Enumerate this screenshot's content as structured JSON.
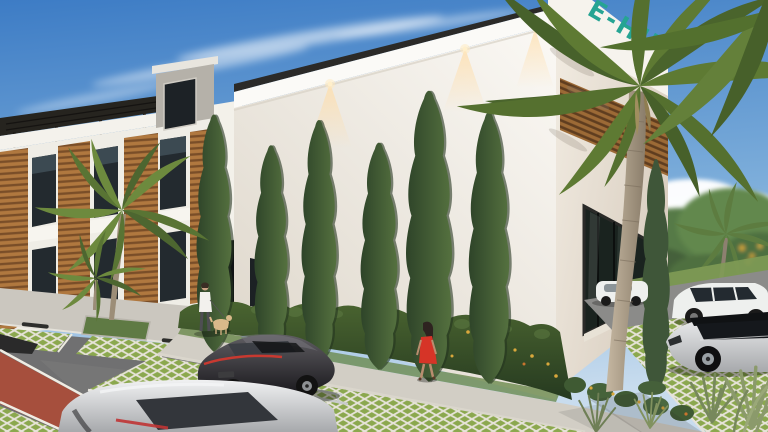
{
  "signage": {
    "text": "E-HUB"
  },
  "palette": {
    "sky_top": "#3d7cc5",
    "sky_mid": "#7cadda",
    "sky_horizon": "#c8dcee",
    "wall_light": "#fbf9f5",
    "wall_shade": "#ded7cb",
    "right_face_light": "#f2ece2",
    "right_face_shade": "#d8cdbf",
    "roof_dark": "#2b2a28",
    "wood": "#b0783f",
    "wood_dark": "#7a4e28",
    "cypress_light": "#55713f",
    "cypress_dark": "#2e4429",
    "hedge_light": "#4a6430",
    "hedge_dark": "#263a20",
    "palm_green": "#5e7a33",
    "palm_green_dark": "#47602a",
    "asphalt": "#707071",
    "red_lane": "#a64f3d",
    "paver_green": "#8ba84e",
    "paver_line": "#e6e3d8",
    "sidewalk": "#cbc7bf",
    "car_black_hi": "#605e63",
    "car_black": "#17161a",
    "car_silver_hi": "#f0f1f2",
    "car_silver": "#a7a9ac",
    "car_white": "#eef0ee",
    "dress_red": "#d63427",
    "sign_teal": "#26a493",
    "trunk_light": "#c6b8a2",
    "trunk_dark": "#8a7d6a",
    "light_warm": "#ffdda8"
  },
  "scene": {
    "description": "Daytime 3D architectural rendering: modern white commercial building with rooftop E-HUB sign, tall cypress trees along the facade, wood-slat accents, palm trees, permeable grass-paver parking, pedestrians and parked cars under a blue sky.",
    "objects": [
      "clear blue sky with wispy cirrus clouds",
      "cumulus clouds on the right horizon",
      "modern white commercial building with rooftop E-HUB sign",
      "row of tall Italian cypress trees along the facade",
      "flowering hedge at the building base",
      "white apartment building with wood-slat columns and rooftop pergola",
      "rooftop stair penthouse",
      "warm facade downlights",
      "glass storefront with black mullions",
      "wood-slat soffit panel",
      "coconut palm trees",
      "black sports coupe parked on grass pavers",
      "silver car driving on the road in the foreground",
      "white SUV and silver SUV parked at right",
      "white sedan behind the palm trunk",
      "man in white shirt walking a dog",
      "woman in a red dress walking along the hedge",
      "asphalt road with red paver cycle lane",
      "green permeable grass-paver parking bays",
      "concrete sidewalks and curbs",
      "ornamental grasses in the foreground corner",
      "distant green treeline"
    ]
  }
}
